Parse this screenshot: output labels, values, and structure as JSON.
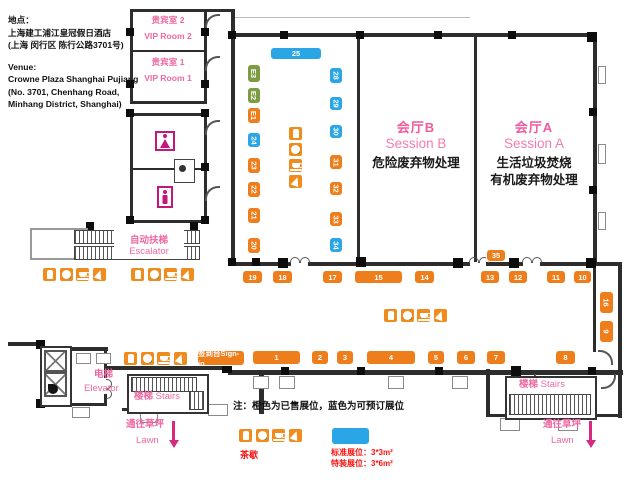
{
  "colors": {
    "sold": "#ee7d1b",
    "available": "#2aa5e6",
    "e_booth": "#7c9b42",
    "pink": "#ee68a2",
    "magenta": "#d62a80",
    "red": "#ff1111",
    "catering": "#f08c1e"
  },
  "address": {
    "cn_label": "地点：",
    "cn_line1": "上海建工浦江皇冠假日酒店",
    "cn_line2": "(上海 闵行区 陈行公路3701号)",
    "en_label": "Venue:",
    "en_line1": "Crowne Plaza Shanghai Pujiang",
    "en_line2": "(No. 3701, Chenhang Road,",
    "en_line3": "Minhang District, Shanghai)"
  },
  "vip": {
    "room2_cn": "贵宾室 2",
    "room2_en": "VIP Room 2",
    "room1_cn": "贵宾室 1",
    "room1_en": "VIP Room 1"
  },
  "sessions": {
    "b_cn": "会厅B",
    "b_en": "Session B",
    "b_topic": "危险废弃物处理",
    "a_cn": "会厅A",
    "a_en": "Session A",
    "a_topic1": "生活垃圾焚烧",
    "a_topic2": "有机废弃物处理"
  },
  "facilities": {
    "escalator_cn": "自动扶梯",
    "escalator_en": "Escalator",
    "elevator_cn": "电梯",
    "elevator_en": "Elevator",
    "stairs_cn": "楼梯",
    "stairs_en": "Stairs",
    "lawn_cn": "通往草坪",
    "lawn_en": "Lawn",
    "signin": "签到台Sign-in"
  },
  "legend": {
    "note": "注：橙色为已售展位，蓝色为可预订展位",
    "tea": "茶歇",
    "standard": "标准展位：3*3m²",
    "special": "特装展位：3*6m²"
  },
  "booths": [
    {
      "label": "25",
      "status": "available",
      "x": 270,
      "y": 47,
      "w": 52,
      "h": 13
    },
    {
      "label": "E3",
      "status": "e_booth",
      "x": 247,
      "y": 64,
      "w": 14,
      "h": 19,
      "vert": true
    },
    {
      "label": "E2",
      "status": "e_booth",
      "x": 247,
      "y": 87,
      "w": 14,
      "h": 17,
      "vert": true
    },
    {
      "label": "E1",
      "status": "sold",
      "x": 247,
      "y": 107,
      "w": 14,
      "h": 17,
      "vert": true
    },
    {
      "label": "24",
      "status": "available",
      "x": 247,
      "y": 132,
      "w": 14,
      "h": 16,
      "vert": true
    },
    {
      "label": "23",
      "status": "sold",
      "x": 247,
      "y": 157,
      "w": 14,
      "h": 17,
      "vert": true
    },
    {
      "label": "22",
      "status": "sold",
      "x": 247,
      "y": 181,
      "w": 14,
      "h": 17,
      "vert": true
    },
    {
      "label": "21",
      "status": "sold",
      "x": 247,
      "y": 207,
      "w": 14,
      "h": 17,
      "vert": true
    },
    {
      "label": "20",
      "status": "sold",
      "x": 247,
      "y": 237,
      "w": 14,
      "h": 17,
      "vert": true
    },
    {
      "label": "28",
      "status": "available",
      "x": 329,
      "y": 67,
      "w": 14,
      "h": 17,
      "vert": true
    },
    {
      "label": "29",
      "status": "available",
      "x": 329,
      "y": 96,
      "w": 14,
      "h": 15,
      "vert": true
    },
    {
      "label": "30",
      "status": "available",
      "x": 329,
      "y": 124,
      "w": 14,
      "h": 15,
      "vert": true
    },
    {
      "label": "31",
      "status": "sold",
      "x": 329,
      "y": 154,
      "w": 14,
      "h": 16,
      "vert": true
    },
    {
      "label": "32",
      "status": "sold",
      "x": 329,
      "y": 181,
      "w": 14,
      "h": 15,
      "vert": true
    },
    {
      "label": "33",
      "status": "sold",
      "x": 329,
      "y": 211,
      "w": 14,
      "h": 16,
      "vert": true
    },
    {
      "label": "34",
      "status": "available",
      "x": 329,
      "y": 237,
      "w": 14,
      "h": 16,
      "vert": true
    },
    {
      "label": "35",
      "status": "sold",
      "x": 486,
      "y": 249,
      "w": 20,
      "h": 13
    },
    {
      "label": "19",
      "status": "sold",
      "x": 242,
      "y": 270,
      "w": 21,
      "h": 14
    },
    {
      "label": "18",
      "status": "sold",
      "x": 272,
      "y": 270,
      "w": 21,
      "h": 14
    },
    {
      "label": "17",
      "status": "sold",
      "x": 322,
      "y": 270,
      "w": 21,
      "h": 14
    },
    {
      "label": "15",
      "status": "sold",
      "x": 354,
      "y": 270,
      "w": 49,
      "h": 14
    },
    {
      "label": "14",
      "status": "sold",
      "x": 414,
      "y": 270,
      "w": 21,
      "h": 14
    },
    {
      "label": "13",
      "status": "sold",
      "x": 480,
      "y": 270,
      "w": 20,
      "h": 14
    },
    {
      "label": "12",
      "status": "sold",
      "x": 508,
      "y": 270,
      "w": 20,
      "h": 14
    },
    {
      "label": "11",
      "status": "sold",
      "x": 546,
      "y": 270,
      "w": 20,
      "h": 14
    },
    {
      "label": "10",
      "status": "sold",
      "x": 573,
      "y": 270,
      "w": 19,
      "h": 14
    },
    {
      "label": "16",
      "status": "sold",
      "x": 599,
      "y": 291,
      "w": 15,
      "h": 23,
      "vert": true
    },
    {
      "label": "9",
      "status": "sold",
      "x": 599,
      "y": 320,
      "w": 15,
      "h": 23,
      "vert": true
    },
    {
      "label": "1",
      "status": "sold",
      "x": 252,
      "y": 350,
      "w": 49,
      "h": 15
    },
    {
      "label": "2",
      "status": "sold",
      "x": 311,
      "y": 350,
      "w": 18,
      "h": 15
    },
    {
      "label": "3",
      "status": "sold",
      "x": 336,
      "y": 350,
      "w": 18,
      "h": 15
    },
    {
      "label": "4",
      "status": "sold",
      "x": 366,
      "y": 350,
      "w": 50,
      "h": 15
    },
    {
      "label": "5",
      "status": "sold",
      "x": 427,
      "y": 350,
      "w": 18,
      "h": 15
    },
    {
      "label": "6",
      "status": "sold",
      "x": 456,
      "y": 350,
      "w": 20,
      "h": 15
    },
    {
      "label": "7",
      "status": "sold",
      "x": 486,
      "y": 350,
      "w": 20,
      "h": 15
    },
    {
      "label": "8",
      "status": "sold",
      "x": 555,
      "y": 350,
      "w": 21,
      "h": 15
    }
  ],
  "catering_types": [
    "drink",
    "snack",
    "coffee",
    "cake"
  ],
  "catering_sets": [
    {
      "x": 288,
      "y": 126,
      "dir": "v"
    },
    {
      "x": 42,
      "y": 267,
      "dir": "h"
    },
    {
      "x": 130,
      "y": 267,
      "dir": "h"
    },
    {
      "x": 383,
      "y": 308,
      "dir": "h"
    },
    {
      "x": 123,
      "y": 351,
      "dir": "h"
    },
    {
      "x": 238,
      "y": 428,
      "dir": "h"
    }
  ]
}
